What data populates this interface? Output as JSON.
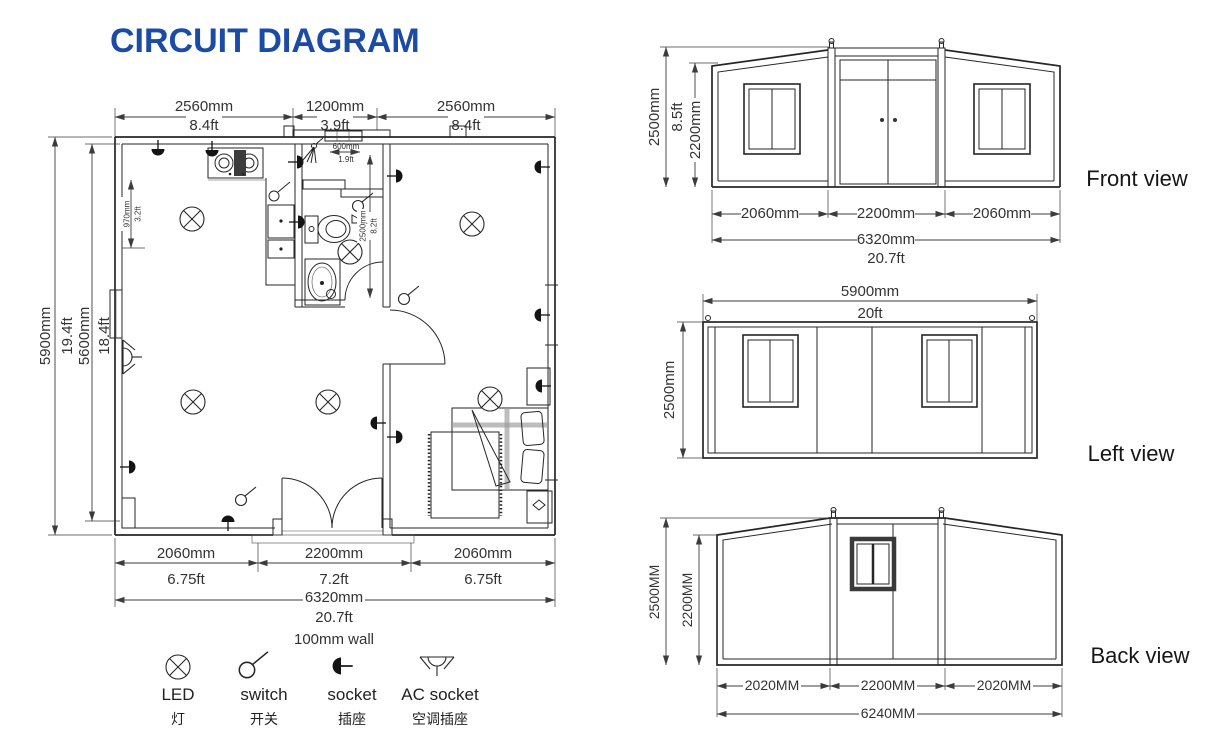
{
  "title": "CIRCUIT DIAGRAM",
  "colors": {
    "title_blue": "#1b4ba4",
    "line": "#262626"
  },
  "plan": {
    "top_dims": [
      {
        "mm": "2560mm",
        "ft": "8.4ft"
      },
      {
        "mm": "1200mm",
        "ft": "3.9ft"
      },
      {
        "mm": "2560mm",
        "ft": "8.4ft"
      }
    ],
    "left_outer": {
      "mm": "5900mm",
      "ft": "19.4ft"
    },
    "left_inner": {
      "mm": "5600mm",
      "ft": "18.4ft"
    },
    "kitchen_depth": {
      "mm": "970mm",
      "ft": "3.2ft"
    },
    "bath_width": {
      "mm": "600mm",
      "ft": "1.9ft"
    },
    "bath_height": {
      "mm": "2500mm",
      "ft": "8.2ft"
    },
    "bottom_dims": [
      {
        "mm": "2060mm",
        "ft": "6.75ft"
      },
      {
        "mm": "2200mm",
        "ft": "7.2ft"
      },
      {
        "mm": "2060mm",
        "ft": "6.75ft"
      }
    ],
    "total": {
      "mm": "6320mm",
      "ft": "20.7ft"
    },
    "wall_note": "100mm wall"
  },
  "legend": {
    "items": [
      {
        "en": "LED",
        "zh": "灯"
      },
      {
        "en": "switch",
        "zh": "开关"
      },
      {
        "en": "socket",
        "zh": "插座"
      },
      {
        "en": "AC socket",
        "zh": "空调插座"
      }
    ]
  },
  "front_view": {
    "label": "Front view",
    "height_outer_mm": "2500mm",
    "height_outer_ft": "8.5ft",
    "height_inner_mm": "2200mm",
    "bottom_dims": [
      "2060mm",
      "2200mm",
      "2060mm"
    ],
    "total_mm": "6320mm",
    "total_ft": "20.7ft"
  },
  "left_view": {
    "label": "Left view",
    "width_mm": "5900mm",
    "width_ft": "20ft",
    "height_mm": "2500mm"
  },
  "back_view": {
    "label": "Back view",
    "height_outer": "2500MM",
    "height_inner": "2200MM",
    "bottom_dims": [
      "2020MM",
      "2200MM",
      "2020MM"
    ],
    "total": "6240MM"
  }
}
